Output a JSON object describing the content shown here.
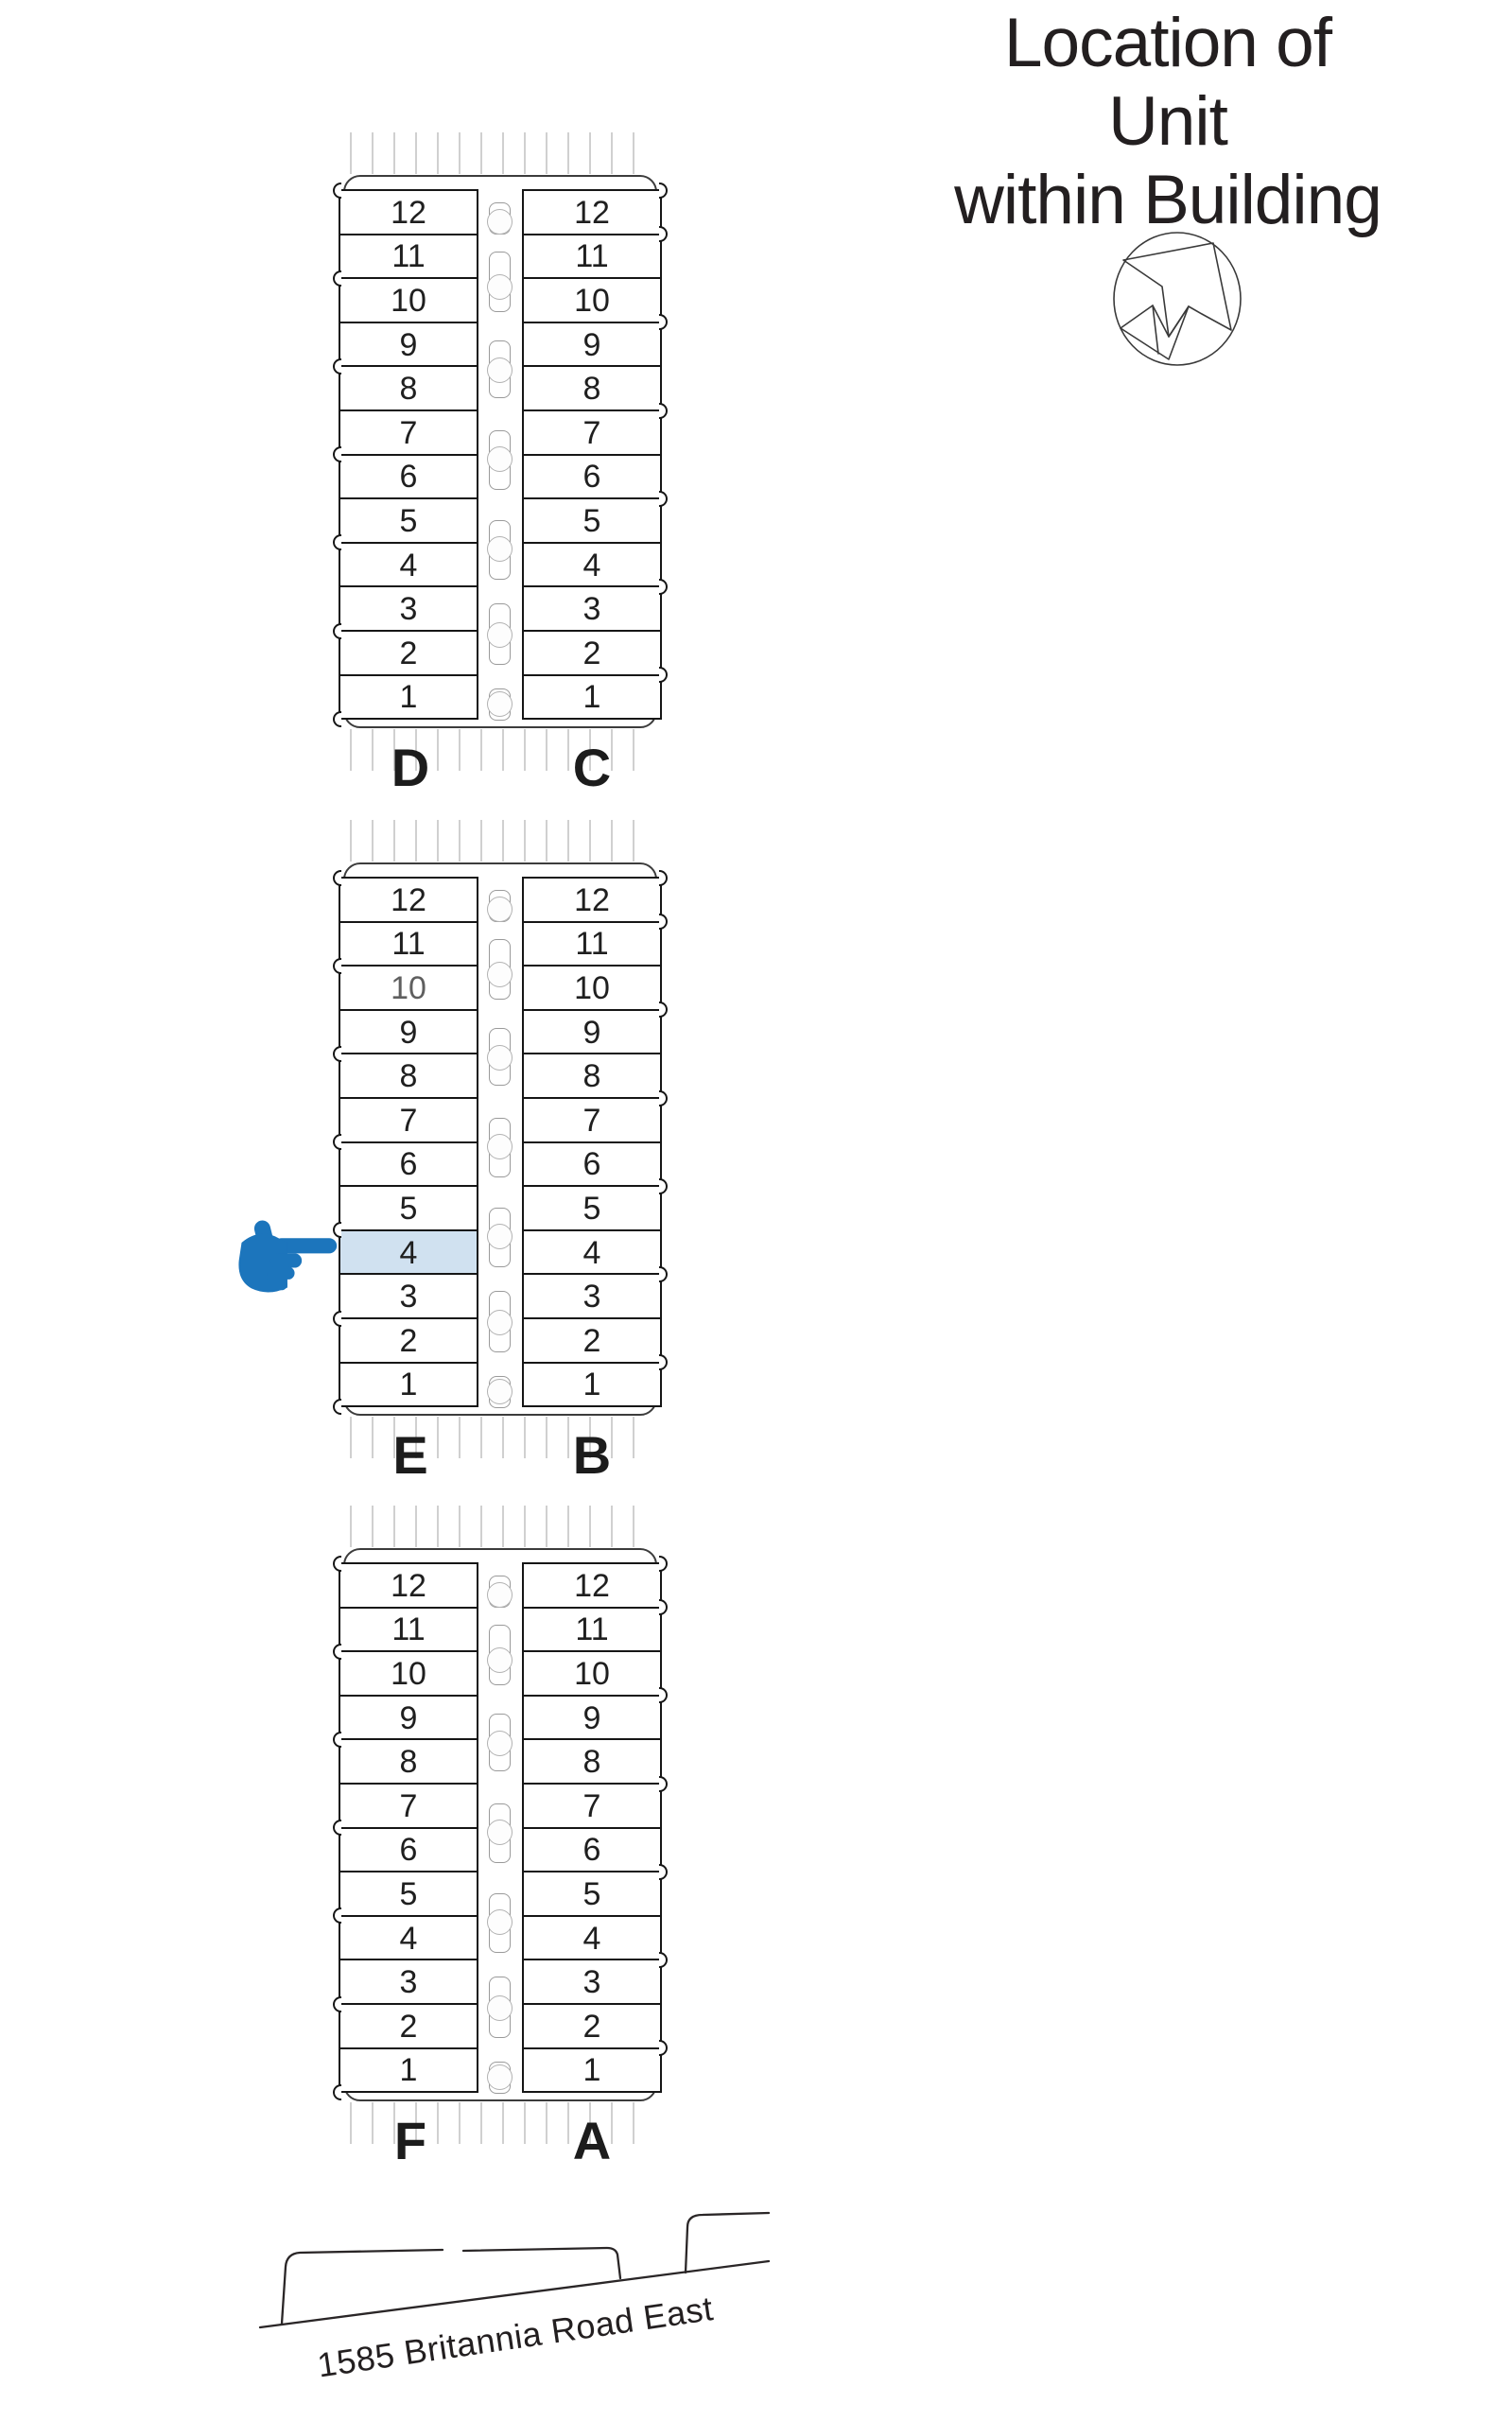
{
  "title": {
    "line1": "Location of Unit",
    "line2": "within Building"
  },
  "compass": {
    "icon": "north-arrow-compass"
  },
  "pointer": {
    "icon": "hand-pointer",
    "color": "#1c75bc",
    "points_to_unit": "4",
    "points_to_column": "E"
  },
  "colors": {
    "highlight_fill": "#d0e1f0",
    "pointer_blue": "#1c75bc",
    "line": "#231f20"
  },
  "buildings": [
    {
      "left": {
        "label": "D",
        "units": [
          "12",
          "11",
          "10",
          "9",
          "8",
          "7",
          "6",
          "5",
          "4",
          "3",
          "2",
          "1"
        ]
      },
      "right": {
        "label": "C",
        "units": [
          "12",
          "11",
          "10",
          "9",
          "8",
          "7",
          "6",
          "5",
          "4",
          "3",
          "2",
          "1"
        ]
      }
    },
    {
      "left": {
        "label": "E",
        "units": [
          "12",
          "11",
          "10",
          "9",
          "8",
          "7",
          "6",
          "5",
          "4",
          "3",
          "2",
          "1"
        ],
        "highlighted_unit": "4",
        "muted_unit": "10"
      },
      "right": {
        "label": "B",
        "units": [
          "12",
          "11",
          "10",
          "9",
          "8",
          "7",
          "6",
          "5",
          "4",
          "3",
          "2",
          "1"
        ]
      }
    },
    {
      "left": {
        "label": "F",
        "units": [
          "12",
          "11",
          "10",
          "9",
          "8",
          "7",
          "6",
          "5",
          "4",
          "3",
          "2",
          "1"
        ]
      },
      "right": {
        "label": "A",
        "units": [
          "12",
          "11",
          "10",
          "9",
          "8",
          "7",
          "6",
          "5",
          "4",
          "3",
          "2",
          "1"
        ]
      }
    }
  ],
  "street": {
    "address": "1585 Britannia Road East"
  }
}
